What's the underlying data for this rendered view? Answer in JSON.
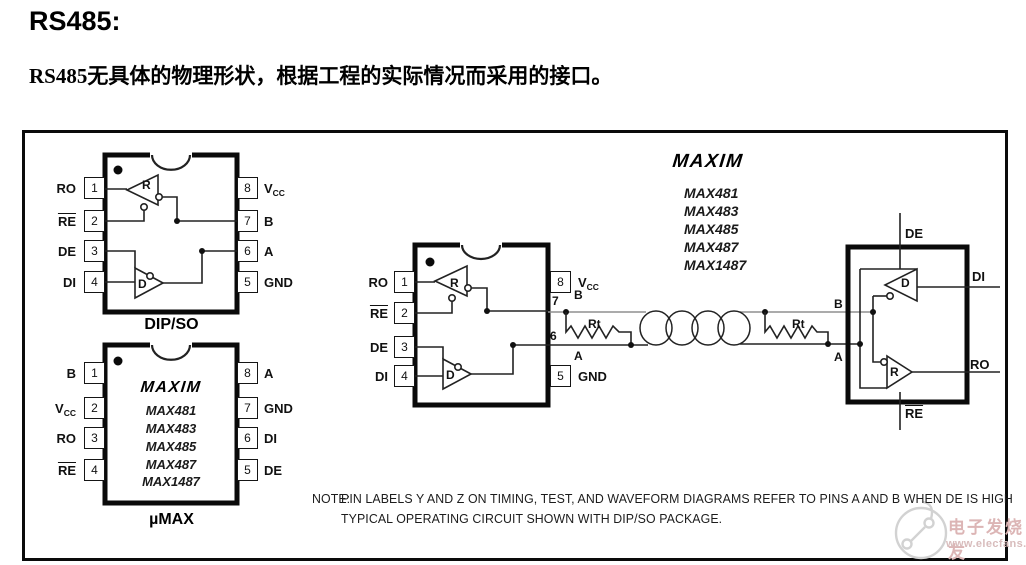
{
  "doc": {
    "title": "RS485:",
    "body": "RS485无具体的物理形状，根据工程的实际情况而采用的接口。"
  },
  "brand": "MAXIM",
  "parts": [
    "MAX481",
    "MAX483",
    "MAX485",
    "MAX487",
    "MAX1487"
  ],
  "dip": {
    "caption": "DIP/SO",
    "receiver": "R",
    "driver": "D",
    "pins_left": [
      {
        "num": "1",
        "label": "RO"
      },
      {
        "num": "2",
        "label": "RE",
        "overline": true
      },
      {
        "num": "3",
        "label": "DE"
      },
      {
        "num": "4",
        "label": "DI"
      }
    ],
    "pins_right": [
      {
        "num": "8",
        "label": "V",
        "sub": "CC"
      },
      {
        "num": "7",
        "label": "B"
      },
      {
        "num": "6",
        "label": "A"
      },
      {
        "num": "5",
        "label": "GND"
      }
    ]
  },
  "umax": {
    "caption": "µMAX",
    "pins_left": [
      {
        "num": "1",
        "label": "B"
      },
      {
        "num": "2",
        "label": "V",
        "sub": "CC"
      },
      {
        "num": "3",
        "label": "RO"
      },
      {
        "num": "4",
        "label": "RE",
        "overline": true
      }
    ],
    "pins_right": [
      {
        "num": "8",
        "label": "A"
      },
      {
        "num": "7",
        "label": "GND"
      },
      {
        "num": "6",
        "label": "DI"
      },
      {
        "num": "5",
        "label": "DE"
      }
    ]
  },
  "circuit": {
    "ic1": {
      "pins_left": [
        {
          "num": "1",
          "label": "RO"
        },
        {
          "num": "2",
          "label": "RE",
          "overline": true
        },
        {
          "num": "3",
          "label": "DE"
        },
        {
          "num": "4",
          "label": "DI"
        }
      ],
      "pin8": {
        "num": "8",
        "label": "V",
        "sub": "CC"
      },
      "pin5": {
        "num": "5",
        "label": "GND"
      },
      "pin7": "7",
      "pin6": "6",
      "b": "B",
      "a": "A",
      "receiver": "R",
      "driver": "D"
    },
    "rt1": "Rt",
    "rt2": "Rt",
    "b": "B",
    "a": "A",
    "ic2": {
      "de": "DE",
      "di": "DI",
      "ro": "RO",
      "re": "RE",
      "driver": "D",
      "receiver": "R"
    }
  },
  "note": {
    "prefix": "NOTE:",
    "line1": "PIN LABELS Y AND Z ON TIMING, TEST, AND WAVEFORM DIAGRAMS REFER TO PINS A AND B WHEN DE IS HIGH",
    "line2": "TYPICAL OPERATING CIRCUIT SHOWN WITH DIP/SO PACKAGE."
  },
  "watermark": {
    "name": "电子发烧友",
    "url": "www.elecfans.com"
  }
}
